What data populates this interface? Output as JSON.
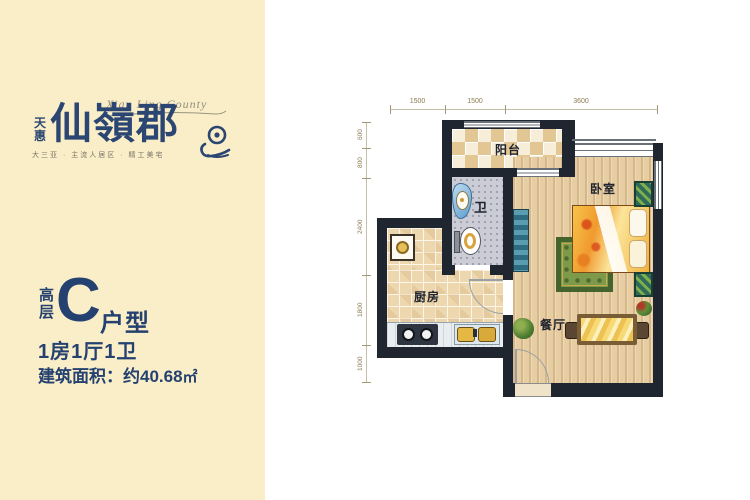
{
  "branding": {
    "script_name": "Xian Ling County",
    "brand_prefix_top": "天",
    "brand_prefix_bottom": "惠",
    "brand_name": "仙嶺郡",
    "tagline": "大三亚 · 主流人居区 · 精工美宅",
    "brand_color": "#2b4672"
  },
  "unit": {
    "floor_char_top": "高",
    "floor_char_bottom": "层",
    "type_letter": "C",
    "type_suffix": "户型",
    "rooms_line": "1房1厅1卫",
    "area_label": "建筑面积：",
    "area_value": "约40.68",
    "area_unit": "㎡",
    "text_color": "#24416f"
  },
  "floorplan": {
    "labels": {
      "balcony": "阳台",
      "bathroom": "卫",
      "kitchen": "厨房",
      "bedroom": "卧室",
      "dining": "餐厅"
    },
    "dims_top": [
      "1500",
      "1500",
      "3600"
    ],
    "dims_left": [
      "600",
      "800",
      "2400",
      "1800",
      "1000"
    ],
    "colors": {
      "wall": "#202630",
      "wood_floor": "#e7cda2",
      "tile_floor": "#ecd7ae",
      "bath_floor": "#cbccd6",
      "background_left": "#f9eec8",
      "background_right": "#ffffff"
    }
  }
}
